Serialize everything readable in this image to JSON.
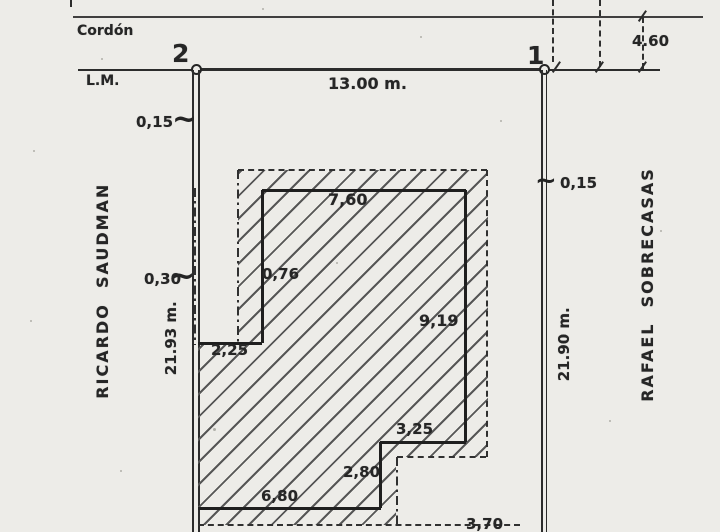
{
  "street": {
    "curb": "Cordón",
    "municipal_line": "L.M."
  },
  "corners": {
    "left": "2",
    "right": "1"
  },
  "dimensions": {
    "front": "13.00 m.",
    "right_offset": "4.60",
    "left_wall_top": "0,15",
    "left_wall_mid": "0,30",
    "left_depth": "21.93 m.",
    "right_wall": "0,15",
    "right_depth": "21.90 m."
  },
  "neighbors": {
    "left": "RICARDO  SAUDMAN",
    "right": "RAFAEL  SOBRECASAS"
  },
  "building": {
    "top_width": "7,60",
    "left_offset": "0,76",
    "right_depth": "9,19",
    "notch_width": "2,25",
    "step_width": "3,25",
    "step_depth": "2,80",
    "bottom_width": "6,80",
    "bottom_ext": "3,70"
  }
}
